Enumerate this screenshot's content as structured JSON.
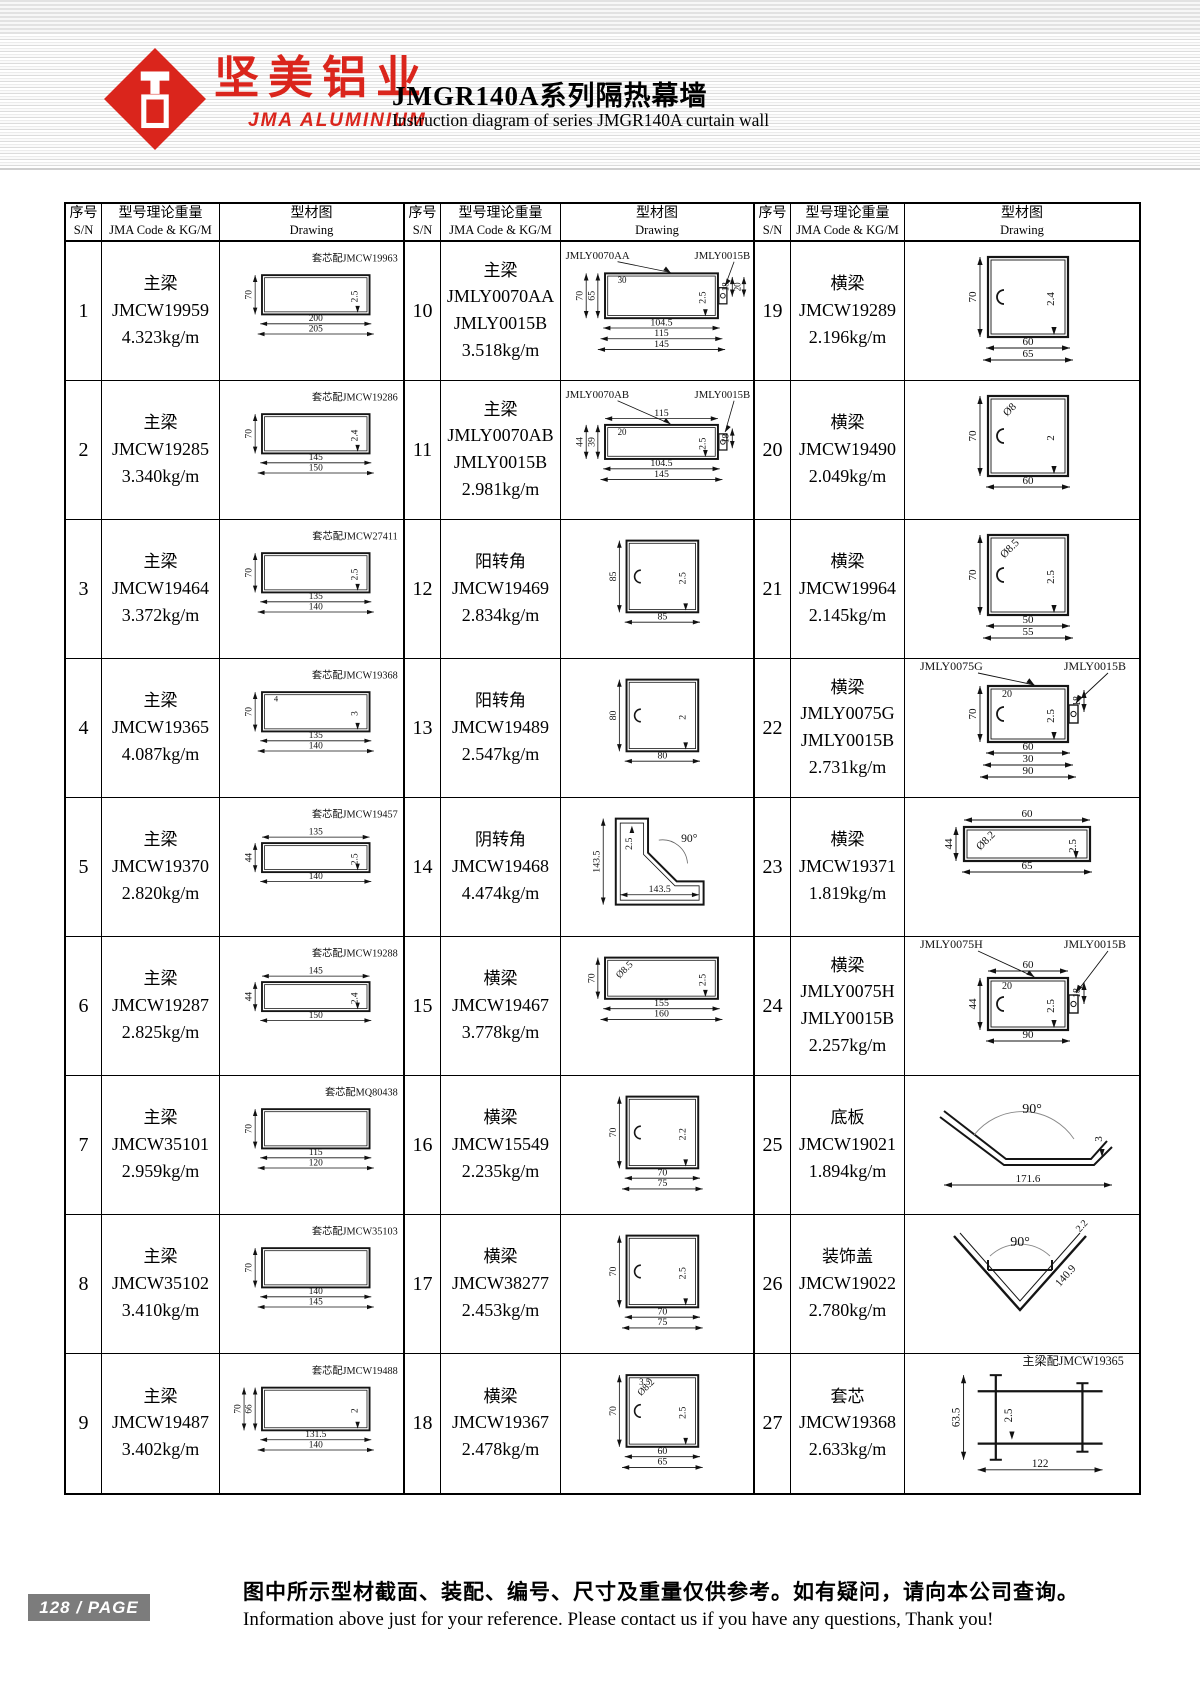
{
  "header": {
    "logo_cn": "坚美铝业",
    "logo_en": "JMA  ALUMINIUM",
    "title_cn": "JMGR140A系列隔热幕墙",
    "title_en": "Instruction diagram of series JMGR140A curtain wall"
  },
  "table_header": {
    "sn_cn": "序号",
    "sn_en": "S/N",
    "code_cn": "型号理论重量",
    "code_en": "JMA Code & KG/M",
    "drawing_cn": "型材图",
    "drawing_en": "Drawing"
  },
  "colors": {
    "brand_red": "#da251c",
    "badge_gray": "#7c7c7c",
    "line": "#151515"
  },
  "entries": [
    {
      "sn": "1",
      "type": "主梁",
      "codes": [
        "JMCW19959"
      ],
      "weight": "4.323kg/m",
      "d": {
        "kind": "wide",
        "note": "套芯配JMCW19963",
        "h": [
          "70"
        ],
        "t": "2.5",
        "bottom": [
          "200",
          "205"
        ]
      }
    },
    {
      "sn": "2",
      "type": "主梁",
      "codes": [
        "JMCW19285"
      ],
      "weight": "3.340kg/m",
      "d": {
        "kind": "wide",
        "note": "套芯配JMCW19286",
        "h": [
          "70"
        ],
        "t": "2.4",
        "bottom": [
          "145",
          "150"
        ]
      }
    },
    {
      "sn": "3",
      "type": "主梁",
      "codes": [
        "JMCW19464"
      ],
      "weight": "3.372kg/m",
      "d": {
        "kind": "wide",
        "note": "套芯配JMCW27411",
        "h": [
          "70"
        ],
        "t": "2.5",
        "bottom": [
          "135",
          "140"
        ]
      }
    },
    {
      "sn": "4",
      "type": "主梁",
      "codes": [
        "JMCW19365"
      ],
      "weight": "4.087kg/m",
      "d": {
        "kind": "wide",
        "note": "套芯配JMCW19368",
        "h": [
          "70"
        ],
        "t": "3",
        "extras": [
          "4"
        ],
        "bottom": [
          "135",
          "140"
        ]
      }
    },
    {
      "sn": "5",
      "type": "主梁",
      "codes": [
        "JMCW19370"
      ],
      "weight": "2.820kg/m",
      "d": {
        "kind": "wide",
        "note": "套芯配JMCW19457",
        "top": [
          "135"
        ],
        "h": [
          "44"
        ],
        "t": "2.5",
        "bottom": [
          "140"
        ]
      }
    },
    {
      "sn": "6",
      "type": "主梁",
      "codes": [
        "JMCW19287"
      ],
      "weight": "2.825kg/m",
      "d": {
        "kind": "wide",
        "note": "套芯配JMCW19288",
        "top": [
          "145"
        ],
        "h": [
          "44"
        ],
        "t": "2.4",
        "bottom": [
          "150"
        ]
      }
    },
    {
      "sn": "7",
      "type": "主梁",
      "codes": [
        "JMCW35101"
      ],
      "weight": "2.959kg/m",
      "d": {
        "kind": "wide",
        "note": "套芯配MQ80438",
        "h": [
          "70"
        ],
        "bottom": [
          "115",
          "120"
        ]
      }
    },
    {
      "sn": "8",
      "type": "主梁",
      "codes": [
        "JMCW35102"
      ],
      "weight": "3.410kg/m",
      "d": {
        "kind": "wide",
        "note": "套芯配JMCW35103",
        "h": [
          "70"
        ],
        "bottom": [
          "140",
          "145"
        ]
      }
    },
    {
      "sn": "9",
      "type": "主梁",
      "codes": [
        "JMCW19487"
      ],
      "weight": "3.402kg/m",
      "d": {
        "kind": "wide",
        "note": "套芯配JMCW19488",
        "h": [
          "70",
          "66"
        ],
        "t": "2",
        "bottom": [
          "131.5",
          "140"
        ]
      }
    },
    {
      "sn": "10",
      "type": "主梁",
      "codes": [
        "JMLY0070AA",
        "JMLY0015B"
      ],
      "weight": "3.518kg/m",
      "d": {
        "kind": "wide",
        "note": "JMLY0070AA",
        "note2": "JMLY0015B",
        "h": [
          "70",
          "65"
        ],
        "t": "2.5",
        "right": [
          "18",
          "20"
        ],
        "extras": [
          "30"
        ],
        "bottom": [
          "104.5",
          "115",
          "145"
        ]
      }
    },
    {
      "sn": "11",
      "type": "主梁",
      "codes": [
        "JMLY0070AB",
        "JMLY0015B"
      ],
      "weight": "2.981kg/m",
      "d": {
        "kind": "wide",
        "note": "JMLY0070AB",
        "note2": "JMLY0015B",
        "top": [
          "115"
        ],
        "h": [
          "44",
          "39"
        ],
        "t": "2.5",
        "right": [
          "18"
        ],
        "extras": [
          "20"
        ],
        "bottom": [
          "104.5",
          "145"
        ]
      }
    },
    {
      "sn": "12",
      "type": "阳转角",
      "codes": [
        "JMCW19469"
      ],
      "weight": "2.834kg/m",
      "d": {
        "kind": "box",
        "h": [
          "85"
        ],
        "t": "2.5",
        "bottom": [
          "85"
        ]
      }
    },
    {
      "sn": "13",
      "type": "阳转角",
      "codes": [
        "JMCW19489"
      ],
      "weight": "2.547kg/m",
      "d": {
        "kind": "box",
        "h": [
          "80"
        ],
        "t": "2",
        "bottom": [
          "80"
        ]
      }
    },
    {
      "sn": "14",
      "type": "阴转角",
      "codes": [
        "JMCW19468"
      ],
      "weight": "4.474kg/m",
      "d": {
        "kind": "corner",
        "h": [
          "143.5"
        ],
        "t": "2.5",
        "mid": "143.5",
        "angle": "90°"
      }
    },
    {
      "sn": "15",
      "type": "横梁",
      "codes": [
        "JMCW19467"
      ],
      "weight": "3.778kg/m",
      "d": {
        "kind": "wide",
        "h": [
          "70"
        ],
        "dia": "Ø8.5",
        "t": "2.5",
        "bottom": [
          "155",
          "160"
        ]
      }
    },
    {
      "sn": "16",
      "type": "横梁",
      "codes": [
        "JMCW15549"
      ],
      "weight": "2.235kg/m",
      "d": {
        "kind": "box",
        "h": [
          "70"
        ],
        "t": "2.2",
        "bottom": [
          "70",
          "75"
        ]
      }
    },
    {
      "sn": "17",
      "type": "横梁",
      "codes": [
        "JMCW38277"
      ],
      "weight": "2.453kg/m",
      "d": {
        "kind": "box",
        "h": [
          "70"
        ],
        "t": "2.5",
        "bottom": [
          "70",
          "75"
        ]
      }
    },
    {
      "sn": "18",
      "type": "横梁",
      "codes": [
        "JMCW19367"
      ],
      "weight": "2.478kg/m",
      "d": {
        "kind": "box",
        "h": [
          "70"
        ],
        "extras": [
          "3.5"
        ],
        "dia": "Ø8.2",
        "t": "2.5",
        "bottom": [
          "60",
          "65"
        ]
      }
    },
    {
      "sn": "19",
      "type": "横梁",
      "codes": [
        "JMCW19289"
      ],
      "weight": "2.196kg/m",
      "d": {
        "kind": "box",
        "h": [
          "70"
        ],
        "t": "2.4",
        "bottom": [
          "60",
          "65"
        ]
      }
    },
    {
      "sn": "20",
      "type": "横梁",
      "codes": [
        "JMCW19490"
      ],
      "weight": "2.049kg/m",
      "d": {
        "kind": "box",
        "dia": "Ø8",
        "h": [
          "70"
        ],
        "t": "2",
        "bottom": [
          "60"
        ]
      }
    },
    {
      "sn": "21",
      "type": "横梁",
      "codes": [
        "JMCW19964"
      ],
      "weight": "2.145kg/m",
      "d": {
        "kind": "box",
        "h": [
          "70"
        ],
        "dia": "Ø8.5",
        "t": "2.5",
        "bottom": [
          "50",
          "55"
        ]
      }
    },
    {
      "sn": "22",
      "type": "横梁",
      "codes": [
        "JMLY0075G",
        "JMLY0015B"
      ],
      "weight": "2.731kg/m",
      "d": {
        "kind": "box",
        "note": "JMLY0075G",
        "note2": "JMLY0015B",
        "h": [
          "70"
        ],
        "t": "2.5",
        "right": [
          "18"
        ],
        "extras": [
          "20"
        ],
        "bottom": [
          "60",
          "30",
          "90"
        ]
      }
    },
    {
      "sn": "23",
      "type": "横梁",
      "codes": [
        "JMCW19371"
      ],
      "weight": "1.819kg/m",
      "d": {
        "kind": "wide",
        "top": [
          "60"
        ],
        "h": [
          "44"
        ],
        "dia": "Ø8.2",
        "t": "2.5",
        "bottom": [
          "65"
        ]
      }
    },
    {
      "sn": "24",
      "type": "横梁",
      "codes": [
        "JMLY0075H",
        "JMLY0015B"
      ],
      "weight": "2.257kg/m",
      "d": {
        "kind": "box",
        "note": "JMLY0075H",
        "note2": "JMLY0015B",
        "top": [
          "60"
        ],
        "h": [
          "44"
        ],
        "t": "2.5",
        "right": [
          "18"
        ],
        "extras": [
          "20"
        ],
        "bottom": [
          "90"
        ]
      }
    },
    {
      "sn": "25",
      "type": "底板",
      "codes": [
        "JMCW19021"
      ],
      "weight": "1.894kg/m",
      "d": {
        "kind": "pan",
        "angle": "90°",
        "t": "3",
        "bottom": [
          "171.6"
        ]
      }
    },
    {
      "sn": "26",
      "type": "装饰盖",
      "codes": [
        "JMCW19022"
      ],
      "weight": "2.780kg/m",
      "d": {
        "kind": "vee",
        "angle": "90°",
        "t": "2.2",
        "slant": "140.9"
      }
    },
    {
      "sn": "27",
      "type": "套芯",
      "codes": [
        "JMCW19368"
      ],
      "weight": "2.633kg/m",
      "d": {
        "kind": "core",
        "note": "主梁配JMCW19365",
        "h": [
          "63.5"
        ],
        "t": "2.5",
        "bottom": [
          "122"
        ]
      }
    }
  ],
  "footer": {
    "page_badge": "128 / PAGE",
    "note_cn": "图中所示型材截面、装配、编号、尺寸及重量仅供参考。如有疑问，请向本公司查询。",
    "note_en": "Information above just for your reference. Please contact us if you have any questions, Thank you!"
  }
}
